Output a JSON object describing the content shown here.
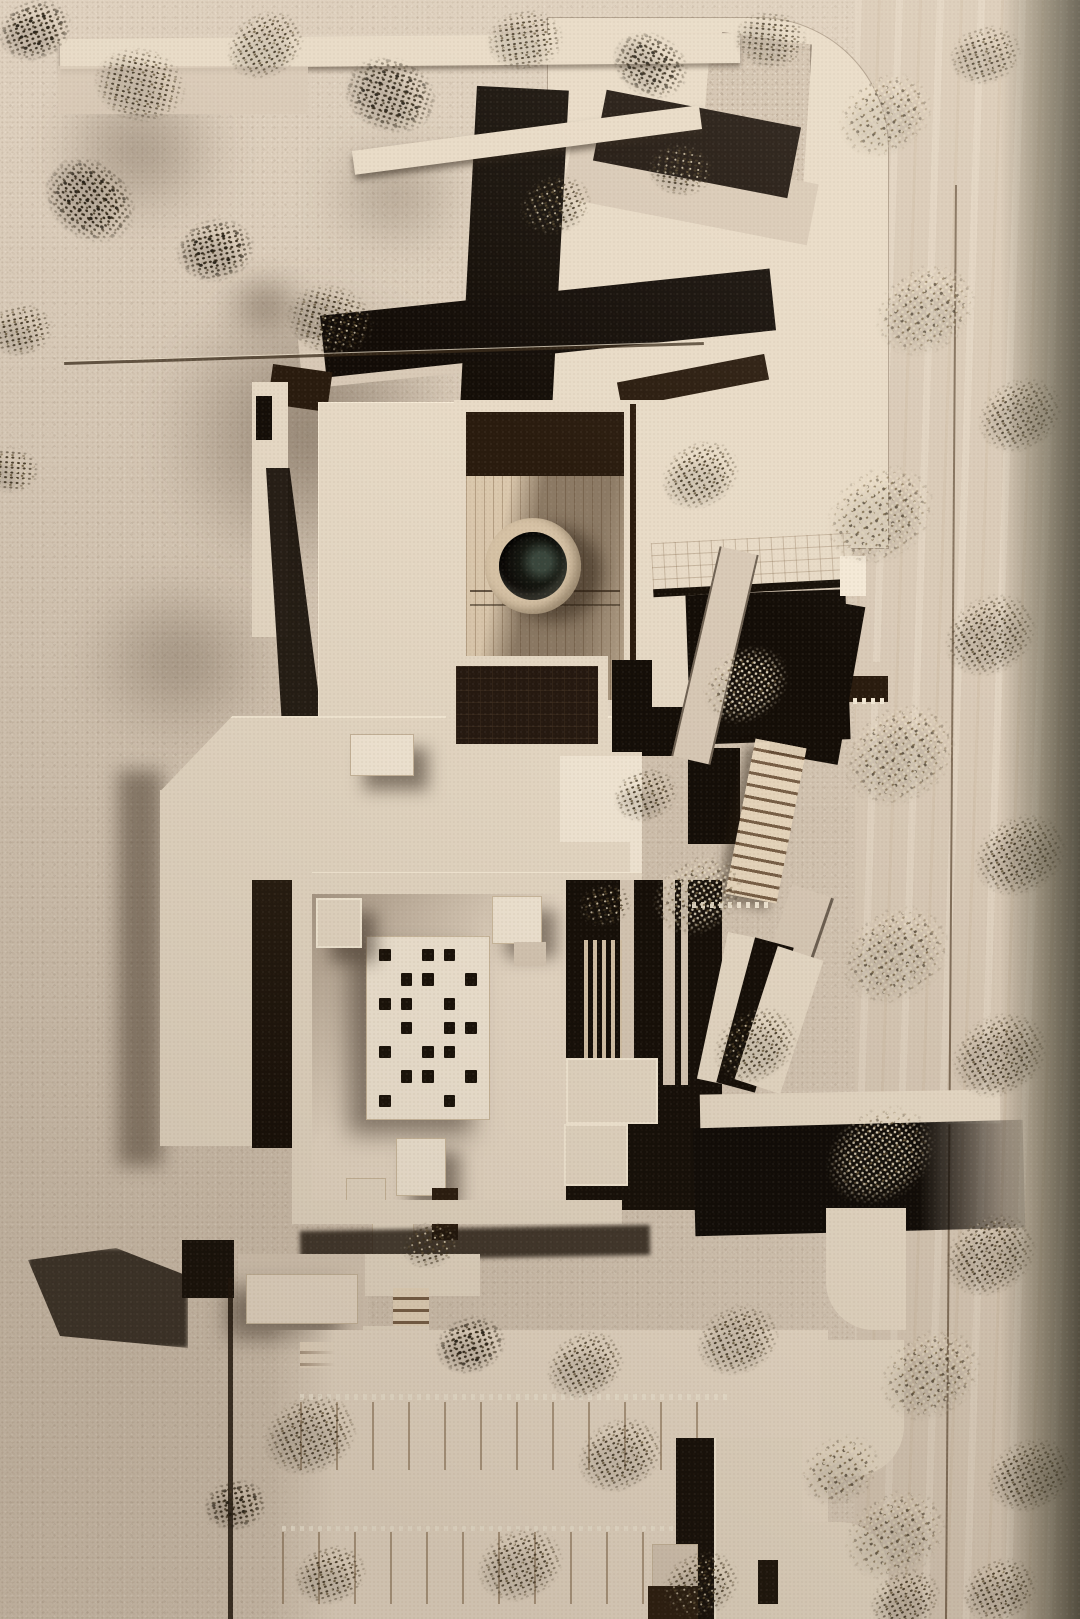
{
  "scene": {
    "title": "Aerial photograph of a wooden architectural scale model",
    "description": "Top-down photo of a basswood/plywood architecture model on a sand-textured board: a central complex with two courtyards, a dark circular reflecting pool in a wood ring, flat roofs with a grid of dark square skylights, angled dark timber slabs and bridges at the top, gridded plazas with rounded corners, a staircase and ramps at the east side, a small annex with steps at the south-west, parking bays with stall lines at the bottom, and rows of dried-plant trees casting long shadows along the top edge, right margin and bottom rows.",
    "medium": "photograph",
    "view": "top-down aerial",
    "lighting": "warm raking sunlight with dappled shade upper-left, deep shadow band along right edge",
    "palette": {
      "sand": "#d3c4b1",
      "sand-light": "#e0d2c0",
      "sand-dark": "#a8947e",
      "ply": "#d9cab7",
      "ply-light": "#eadcc9",
      "pale": "#e8dbc7",
      "pale-bright": "#f4e9d7",
      "wood-mid": "#c7b499",
      "wood-deep": "#a08463",
      "dark": "#130d07",
      "dark2": "#291b0e",
      "brown": "#4a3724",
      "olive": "#54503e",
      "tree-dark": "#3f3420",
      "tree-mid": "#6a5939",
      "tree-light": "#eadfc2",
      "pool-ring": "#d8c4a7",
      "pool-glass": "#0b0806",
      "pool-glint": "#39463c",
      "shadow": "#2b2015"
    },
    "pool": {
      "center_x": 533,
      "center_y": 566,
      "outer_radius": 48,
      "basin_radius": 34
    },
    "skylight_pattern": [
      "10110",
      "01101",
      "11010",
      "01011",
      "10110",
      "01101",
      "10010"
    ],
    "trees": {
      "note": "each item = [center_x, center_y, size_px, rotation_deg, variant(0 dark,1 mixed,2 light)]",
      "items": [
        [
          35,
          30,
          100,
          -20,
          0
        ],
        [
          140,
          85,
          120,
          12,
          1
        ],
        [
          265,
          45,
          105,
          -30,
          1
        ],
        [
          390,
          95,
          125,
          18,
          0
        ],
        [
          525,
          40,
          100,
          -8,
          1
        ],
        [
          650,
          65,
          105,
          28,
          0
        ],
        [
          770,
          40,
          95,
          5,
          1
        ],
        [
          90,
          200,
          130,
          38,
          0
        ],
        [
          215,
          250,
          105,
          -12,
          0
        ],
        [
          330,
          320,
          115,
          14,
          1
        ],
        [
          555,
          205,
          95,
          -22,
          1
        ],
        [
          680,
          170,
          85,
          8,
          1
        ],
        [
          20,
          330,
          85,
          -12,
          1
        ],
        [
          10,
          470,
          75,
          4,
          1
        ],
        [
          885,
          115,
          125,
          -32,
          2
        ],
        [
          985,
          55,
          95,
          -18,
          1
        ],
        [
          925,
          310,
          135,
          -35,
          2
        ],
        [
          1020,
          415,
          115,
          -30,
          1
        ],
        [
          880,
          515,
          145,
          -35,
          2
        ],
        [
          990,
          635,
          125,
          -32,
          1
        ],
        [
          900,
          755,
          150,
          -35,
          2
        ],
        [
          1020,
          855,
          125,
          -30,
          1
        ],
        [
          895,
          955,
          145,
          -34,
          2
        ],
        [
          1000,
          1055,
          130,
          -30,
          1
        ],
        [
          880,
          1155,
          145,
          -35,
          2
        ],
        [
          990,
          1255,
          125,
          -32,
          1
        ],
        [
          930,
          1375,
          135,
          -33,
          2
        ],
        [
          1030,
          1475,
          115,
          -26,
          1
        ],
        [
          895,
          1535,
          135,
          -30,
          2
        ],
        [
          1000,
          1590,
          100,
          -25,
          1
        ],
        [
          700,
          475,
          105,
          -30,
          1
        ],
        [
          745,
          685,
          115,
          -34,
          2
        ],
        [
          698,
          895,
          120,
          -32,
          2
        ],
        [
          755,
          1045,
          115,
          -34,
          1
        ],
        [
          645,
          795,
          85,
          -20,
          1
        ],
        [
          605,
          905,
          70,
          -15,
          1
        ],
        [
          310,
          1435,
          125,
          -24,
          1
        ],
        [
          470,
          1345,
          95,
          -18,
          0
        ],
        [
          585,
          1365,
          105,
          -28,
          1
        ],
        [
          738,
          1340,
          110,
          -24,
          1
        ],
        [
          620,
          1455,
          115,
          -28,
          1
        ],
        [
          840,
          1470,
          105,
          -33,
          2
        ],
        [
          520,
          1565,
          115,
          -24,
          1
        ],
        [
          700,
          1585,
          105,
          -28,
          1
        ],
        [
          330,
          1575,
          95,
          -18,
          1
        ],
        [
          235,
          1505,
          85,
          -12,
          0
        ],
        [
          430,
          1245,
          75,
          -18,
          1
        ],
        [
          905,
          1600,
          95,
          -28,
          1
        ]
      ]
    }
  }
}
